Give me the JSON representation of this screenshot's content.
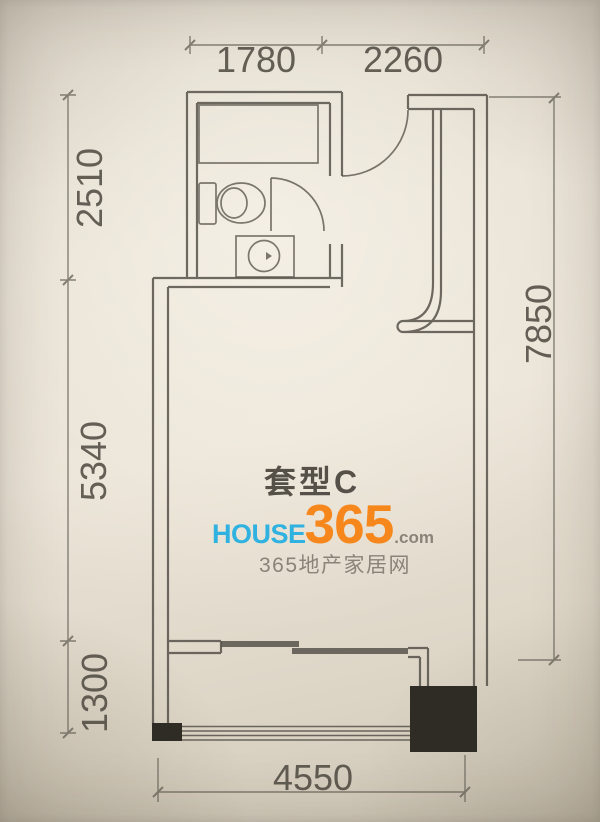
{
  "plan": {
    "title": "套型C",
    "dimensions": {
      "top": [
        "1780",
        "2260"
      ],
      "left": [
        "2510",
        "5340",
        "1300"
      ],
      "right": [
        "7850"
      ],
      "bottom": [
        "4550"
      ]
    }
  },
  "watermark": {
    "brand": {
      "house": "HOUSE",
      "number": "365",
      "domain": ".com"
    },
    "tagline": "365地产家居网",
    "colors": {
      "house_blue": "#2fb2e0",
      "number_orange": "#f6871c",
      "domain_gray": "#8a8478",
      "pencil_line": "#56524a"
    }
  }
}
